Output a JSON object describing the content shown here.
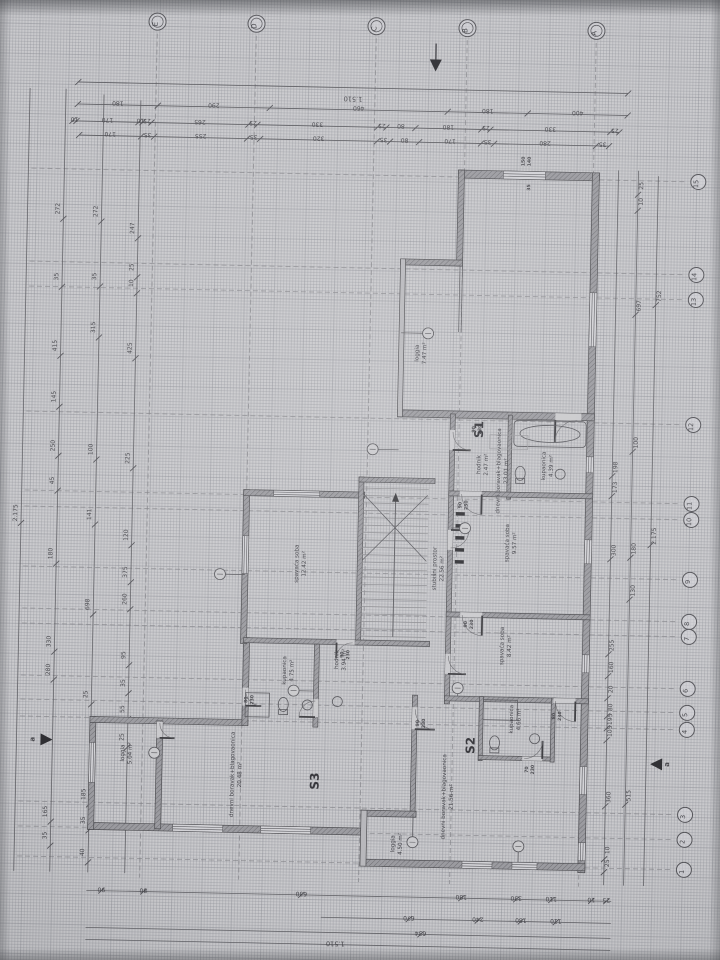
{
  "drawing": {
    "colors": {
      "paper": "#c9c9cc",
      "line": "#55555a",
      "line_soft": "#7d7d82",
      "wall": "#9a9a9f",
      "wall_edge": "#4c4c50",
      "text": "#3f3f45",
      "dim_text": "#46464b",
      "window": "#d2d2d6"
    },
    "axes": {
      "top": [
        "E",
        "D",
        "C",
        "B",
        "A"
      ],
      "right": [
        "15",
        "14",
        "13",
        "12",
        "11",
        "10",
        "9",
        "8",
        "7",
        "6",
        "5",
        "4",
        "3",
        "2",
        "1"
      ]
    },
    "dims": {
      "top_total": "1.510",
      "top_row2": [
        "180",
        "290",
        "460",
        "180",
        "400"
      ],
      "top_row3": [
        "10",
        "170",
        "10",
        "25",
        "265",
        "25",
        "330",
        "25",
        "80",
        "180",
        "25",
        "330",
        "25"
      ],
      "top_row4": [
        "170",
        "35",
        "255",
        "35",
        "320",
        "35",
        "80",
        "170",
        "35",
        "280",
        "35"
      ],
      "left": [
        "2.175",
        "272",
        "35",
        "415",
        "145",
        "250",
        "45",
        "180",
        "330",
        "280",
        "165",
        "35",
        "272",
        "35",
        "315",
        "100",
        "141",
        "698",
        "25",
        "185",
        "35",
        "40",
        "247",
        "25",
        "10",
        "425",
        "225",
        "120",
        "375",
        "260",
        "95",
        "35",
        "55",
        "25"
      ],
      "right": [
        "25",
        "10",
        "697",
        "100",
        "180",
        "130",
        "515",
        "752",
        "2.175",
        "198",
        "173",
        "300",
        "255",
        "160",
        "20",
        "80",
        "195",
        "105",
        "360",
        "10",
        "25"
      ],
      "bottom": [
        "90",
        "80",
        "630",
        "180",
        "330",
        "110",
        "10",
        "25",
        "670",
        "240",
        "180",
        "110",
        "634"
      ],
      "bottom_total": "1.510"
    },
    "door_tags": [
      [
        "150",
        "140"
      ],
      [
        "35"
      ],
      [
        "90",
        "230"
      ],
      [
        "90",
        "230"
      ],
      [
        "90",
        "230"
      ],
      [
        "80",
        "230"
      ],
      [
        "90",
        "230"
      ],
      [
        "70",
        "230"
      ],
      [
        "90",
        "230"
      ],
      [
        "80",
        "230"
      ]
    ],
    "apartments": [
      {
        "id": "S1",
        "rooms": [
          {
            "name": "dnevni boravak+blagovaonica",
            "area": "23.01 m²"
          },
          {
            "name": "loggia",
            "area": "7.47 m²"
          },
          {
            "name": "hodnik",
            "area": "2.47 m²"
          },
          {
            "name": "kupaonica",
            "area": "4.39 m²"
          }
        ]
      },
      {
        "id": "S2",
        "rooms": [
          {
            "name": "spavaća soba",
            "area": "9.57 m²"
          },
          {
            "name": "spavaća soba",
            "area": "8.42 m²"
          },
          {
            "name": "kupaonica",
            "area": "4.66 m²"
          },
          {
            "name": "dnevni boravak+blagovaonica",
            "area": "21.56 m²"
          },
          {
            "name": "loggia",
            "area": "4.50 m²"
          }
        ]
      },
      {
        "id": "S3",
        "rooms": [
          {
            "name": "spavaća soba",
            "area": "12.42 m²"
          },
          {
            "name": "kupaonica",
            "area": "4.75 m²"
          },
          {
            "name": "hodnik",
            "area": "3.94 m²"
          },
          {
            "name": "dnevni boravak+blagovaonica",
            "area": "20.48 m²"
          },
          {
            "name": "loggia",
            "area": "5.04 m²"
          }
        ]
      }
    ],
    "stair": {
      "name": "stubišni prostor",
      "area": "22.56 m²"
    },
    "section_letter": "a"
  }
}
